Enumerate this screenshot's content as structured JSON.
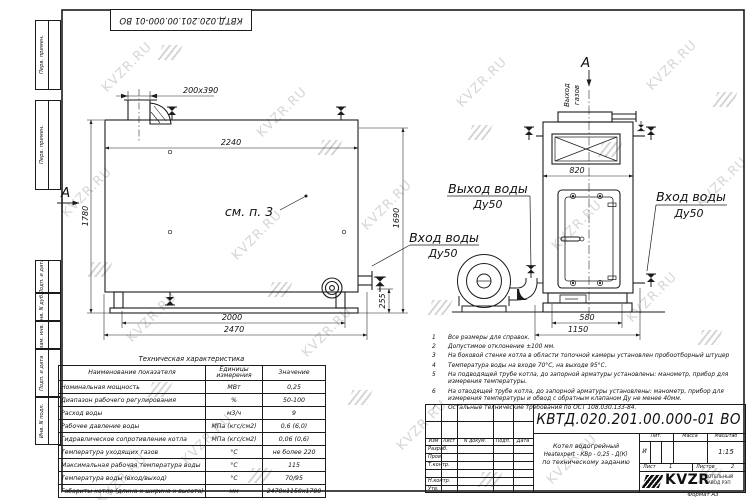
{
  "doc": {
    "number": "КВТД.020.201.00.000-01 ВО",
    "stamp_number": "КВТД.020.201.00.000-01 ВО",
    "format": "Формат  А3",
    "liter_label": "Лит.",
    "liter": "И",
    "mass_label": "Масса",
    "scale_label": "Масштаб",
    "scale": "1:15",
    "sheet_label": "Лист",
    "sheet_number": "1",
    "sheets_label": "Листов",
    "sheets_number": "2",
    "title_line1": "Котел водогрейный",
    "title_line2": "Heatexpert - КВр - 0,25 - Д(К)",
    "title_line3": "по техническому заданию"
  },
  "stamp": {
    "col_headers": [
      "Изм",
      "Лист",
      "N докум.",
      "Подп.",
      "Дата"
    ],
    "row_labels": [
      "Разраб.",
      "Пров.",
      "Т.контр.",
      "Н.контр.",
      "Утв."
    ]
  },
  "org": {
    "logo_text": "KVZR",
    "org_line1": "КОТЕЛЬНЫЙ",
    "org_line2": "ЗАВОД РЭП"
  },
  "sidebar": {
    "labels": [
      "Перв. примен.",
      "Перв. примен.",
      "Подп. и дата",
      "Инв. N дубл.",
      "Взам. инв. N",
      "Подп. и дата",
      "Инв. N подл."
    ]
  },
  "branding": {
    "watermark": "KVZR.RU"
  },
  "views": {
    "section_label": "А",
    "see_note": "см. п. 3",
    "gas_outlet_word1": "Выход",
    "gas_outlet_word2": "газов",
    "water_out_label": "Выход воды",
    "water_out_dn": "Ду50",
    "water_in_label": "Вход воды",
    "water_in_dn": "Ду50"
  },
  "dims": {
    "chimney": "200x390",
    "width_top": "2240",
    "height_left": "1780",
    "height_right": "1690",
    "bottom_inner": "2000",
    "bottom_outer": "2470",
    "pipe_height": "255",
    "front_width": "820",
    "base_inner": "580",
    "base_outer": "1150"
  },
  "notes": {
    "items": [
      {
        "n": "1",
        "text": "Все размеры для справок."
      },
      {
        "n": "2",
        "text": "Допустимое отклонение ±100 мм."
      },
      {
        "n": "3",
        "text": "На боковой стенке котла в области топочной камеры установлен пробоотборный штуцер"
      },
      {
        "n": "4",
        "text": "Температура воды на входе 70°С, на выходе 95°С."
      },
      {
        "n": "5",
        "text": "На подводящей трубе котла, до запорной арматуры установлены: манометр, прибор для измерения температуры."
      },
      {
        "n": "6",
        "text": "На отводящей трубе котла, до запорной арматуры установлены: манометр, прибор для измерения температуры и обвод с обратным клапаном Ду не менее 40мм."
      },
      {
        "n": "7",
        "text": "Остальные технические требования по ОСТ 108.030.133-84."
      }
    ]
  },
  "table": {
    "title": "Техническая характеристика",
    "headers": [
      "Наименование показателя",
      "Единицы измерения",
      "Значение"
    ],
    "rows": [
      [
        "Номинальная мощность",
        "МВт",
        "0,25"
      ],
      [
        "Диапазон рабочего регулирования",
        "%",
        "50-100"
      ],
      [
        "Расход воды",
        "м3/ч",
        "9"
      ],
      [
        "Рабочее давление воды",
        "МПа (кгс/см2)",
        "0,6 (6,0)"
      ],
      [
        "Гидравлическое сопротивление котла",
        "МПа (кгс/см2)",
        "0,06 (0,6)"
      ],
      [
        "Температура уходящих газов",
        "°С",
        "не более 220"
      ],
      [
        "Максимальная рабочая температура воды",
        "°С",
        "115"
      ],
      [
        "Температура воды (вход/выход)",
        "°С",
        "70/95"
      ],
      [
        "Габариты котла (длина х ширина х высота)",
        "мм",
        "2470х1150х1780"
      ]
    ]
  }
}
